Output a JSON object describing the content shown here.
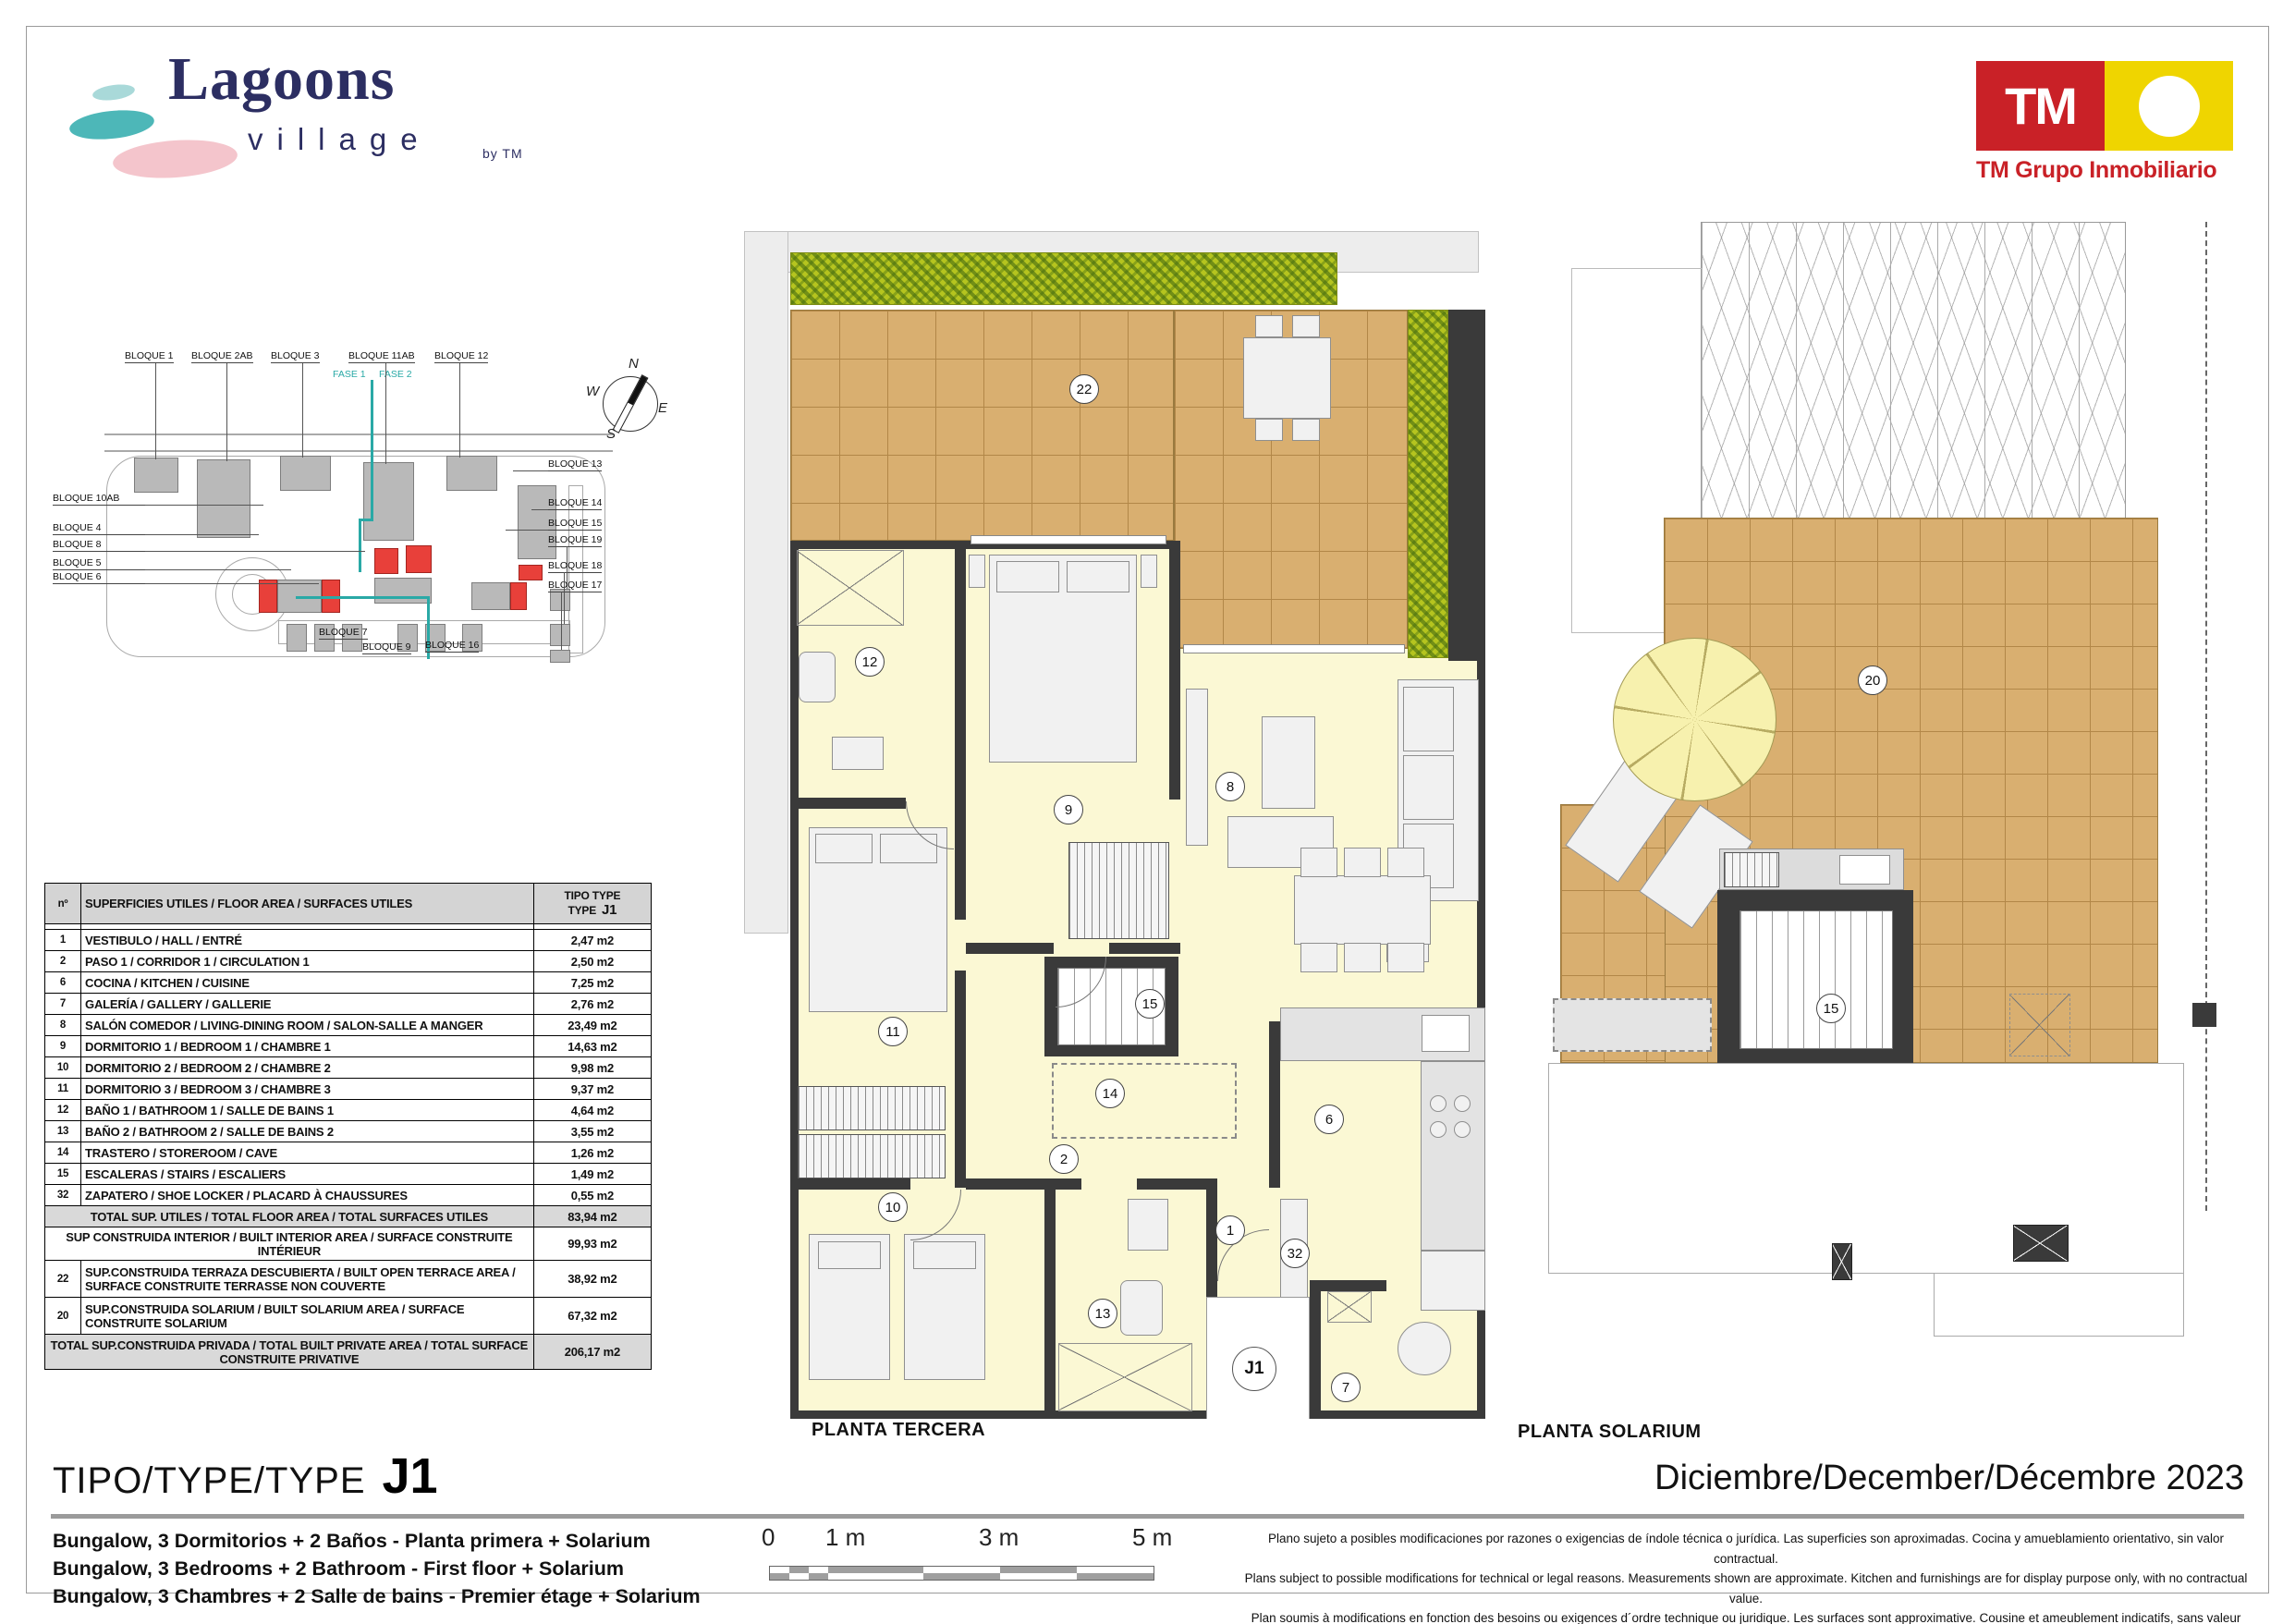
{
  "header": {
    "brand": {
      "title": "Lagoons",
      "subtitle": "village",
      "byline": "by TM"
    },
    "company": {
      "logo_text": "TM",
      "caption": "TM Grupo Inmobiliario"
    }
  },
  "site_plan": {
    "fase": [
      "FASE 1",
      "FASE 2"
    ],
    "compass": {
      "n": "N",
      "e": "E",
      "s": "S",
      "w": "W"
    },
    "labels_top": [
      "BLOQUE 1",
      "BLOQUE 2AB",
      "BLOQUE 3",
      "BLOQUE 11AB",
      "BLOQUE 12"
    ],
    "labels_left": [
      "BLOQUE 10AB",
      "BLOQUE 4",
      "BLOQUE 8",
      "BLOQUE 5",
      "BLOQUE 6"
    ],
    "labels_right": [
      "BLOQUE 13",
      "BLOQUE 14",
      "BLOQUE 15",
      "BLOQUE 19",
      "BLOQUE 18",
      "BLOQUE 17"
    ],
    "labels_bottom": [
      "BLOQUE 7",
      "BLOQUE 9",
      "BLOQUE 16"
    ]
  },
  "area_table": {
    "col_num": "nº",
    "col_desc": "SUPERFICIES UTILES / FLOOR AREA / SURFACES UTILES",
    "col_type_l1": "TIPO TYPE",
    "col_type_l2": "TYPE",
    "col_type_code": "J1",
    "rows": [
      {
        "num": "1",
        "desc": "VESTIBULO / HALL / ENTRÉ",
        "val": "2,47 m2"
      },
      {
        "num": "2",
        "desc": "PASO 1 / CORRIDOR 1 / CIRCULATION 1",
        "val": "2,50 m2"
      },
      {
        "num": "6",
        "desc": "COCINA / KITCHEN / CUISINE",
        "val": "7,25 m2"
      },
      {
        "num": "7",
        "desc": "GALERÍA / GALLERY / GALLERIE",
        "val": "2,76 m2"
      },
      {
        "num": "8",
        "desc": "SALÓN COMEDOR  / LIVING-DINING ROOM / SALON-SALLE A MANGER",
        "val": "23,49 m2"
      },
      {
        "num": "9",
        "desc": "DORMITORIO 1 / BEDROOM 1 / CHAMBRE 1",
        "val": "14,63 m2"
      },
      {
        "num": "10",
        "desc": "DORMITORIO 2 / BEDROOM 2 / CHAMBRE 2",
        "val": "9,98 m2"
      },
      {
        "num": "11",
        "desc": "DORMITORIO 3 / BEDROOM 3 / CHAMBRE 3",
        "val": "9,37 m2"
      },
      {
        "num": "12",
        "desc": "BAÑO 1 / BATHROOM 1 / SALLE DE BAINS 1",
        "val": "4,64 m2"
      },
      {
        "num": "13",
        "desc": "BAÑO 2 / BATHROOM 2 / SALLE DE BAINS 2",
        "val": "3,55 m2"
      },
      {
        "num": "14",
        "desc": "TRASTERO / STOREROOM / CAVE",
        "val": "1,26 m2"
      },
      {
        "num": "15",
        "desc": "ESCALERAS / STAIRS / ESCALIERS",
        "val": "1,49 m2"
      },
      {
        "num": "32",
        "desc": "ZAPATERO / SHOE LOCKER / PLACARD À CHAUSSURES",
        "val": "0,55 m2"
      }
    ],
    "total_utiles": {
      "desc": "TOTAL SUP. UTILES / TOTAL FLOOR AREA / TOTAL SURFACES UTILES",
      "val": "83,94 m2"
    },
    "built_interior": {
      "desc": "SUP CONSTRUIDA INTERIOR / BUILT INTERIOR AREA /  SURFACE CONSTRUITE INTÉRIEUR",
      "val": "99,93 m2"
    },
    "terrace": {
      "num": "22",
      "desc": "SUP.CONSTRUIDA TERRAZA DESCUBIERTA  / BUILT OPEN TERRACE  AREA / SURFACE CONSTRUITE TERRASSE NON COUVERTE",
      "val": "38,92 m2"
    },
    "solarium": {
      "num": "20",
      "desc": "SUP.CONSTRUIDA SOLARIUM / BUILT SOLARIUM AREA / SURFACE CONSTRUITE SOLARIUM",
      "val": "67,32 m2"
    },
    "total_private": {
      "desc": "TOTAL SUP.CONSTRUIDA PRIVADA / TOTAL  BUILT PRIVATE AREA / TOTAL SURFACE CONSTRUITE PRIVATIVE",
      "val": "206,17 m2"
    }
  },
  "plans": {
    "tercera": {
      "label": "PLANTA TERCERA",
      "unit": "J1",
      "circles": [
        "22",
        "12",
        "9",
        "8",
        "11",
        "15",
        "14",
        "2",
        "6",
        "10",
        "13",
        "1",
        "32",
        "7"
      ]
    },
    "solarium": {
      "label": "PLANTA SOLARIUM",
      "circles": [
        "20",
        "15"
      ]
    }
  },
  "footer": {
    "type_label": "TIPO/TYPE/TYPE",
    "type_code": "J1",
    "date": "Diciembre/December/Décembre 2023",
    "descriptions": [
      "Bungalow, 3 Dormitorios + 2 Baños - Planta primera + Solarium",
      "Bungalow, 3 Bedrooms + 2 Bathroom - First floor + Solarium",
      "Bungalow, 3 Chambres + 2 Salle de bains - Premier étage + Solarium"
    ],
    "scale_ticks": [
      "0",
      "1 m",
      "3 m",
      "5 m"
    ],
    "disclaimer": [
      "Plano sujeto a posibles modificaciones por razones o exigencias de índole técnica o jurídica. Las superficies son aproximadas. Cocina y amueblamiento orientativo, sin valor contractual.",
      "Plans subject to possible modifications for technical or legal reasons. Measurements shown are approximate. Kitchen and furnishings are for display purpose only, with no contractual value.",
      "Plan soumis à modifications en fonction des besoins ou exigences d´ordre technique ou juridique. Les surfaces sont approximative. Cousine et ameublement indicatifs, sans valeur contratuelle."
    ]
  },
  "colors": {
    "accent_teal": "#2aa9a6",
    "brand_navy": "#2c2e62",
    "tm_red": "#c92127",
    "tm_yellow": "#efd500",
    "highlight_red": "#e8403a",
    "terrace_tan": "#d9af70",
    "hedge_green": "#b5c41f",
    "interior_yellow": "#fbf8d4",
    "wall_dark": "#3a3a3a"
  }
}
